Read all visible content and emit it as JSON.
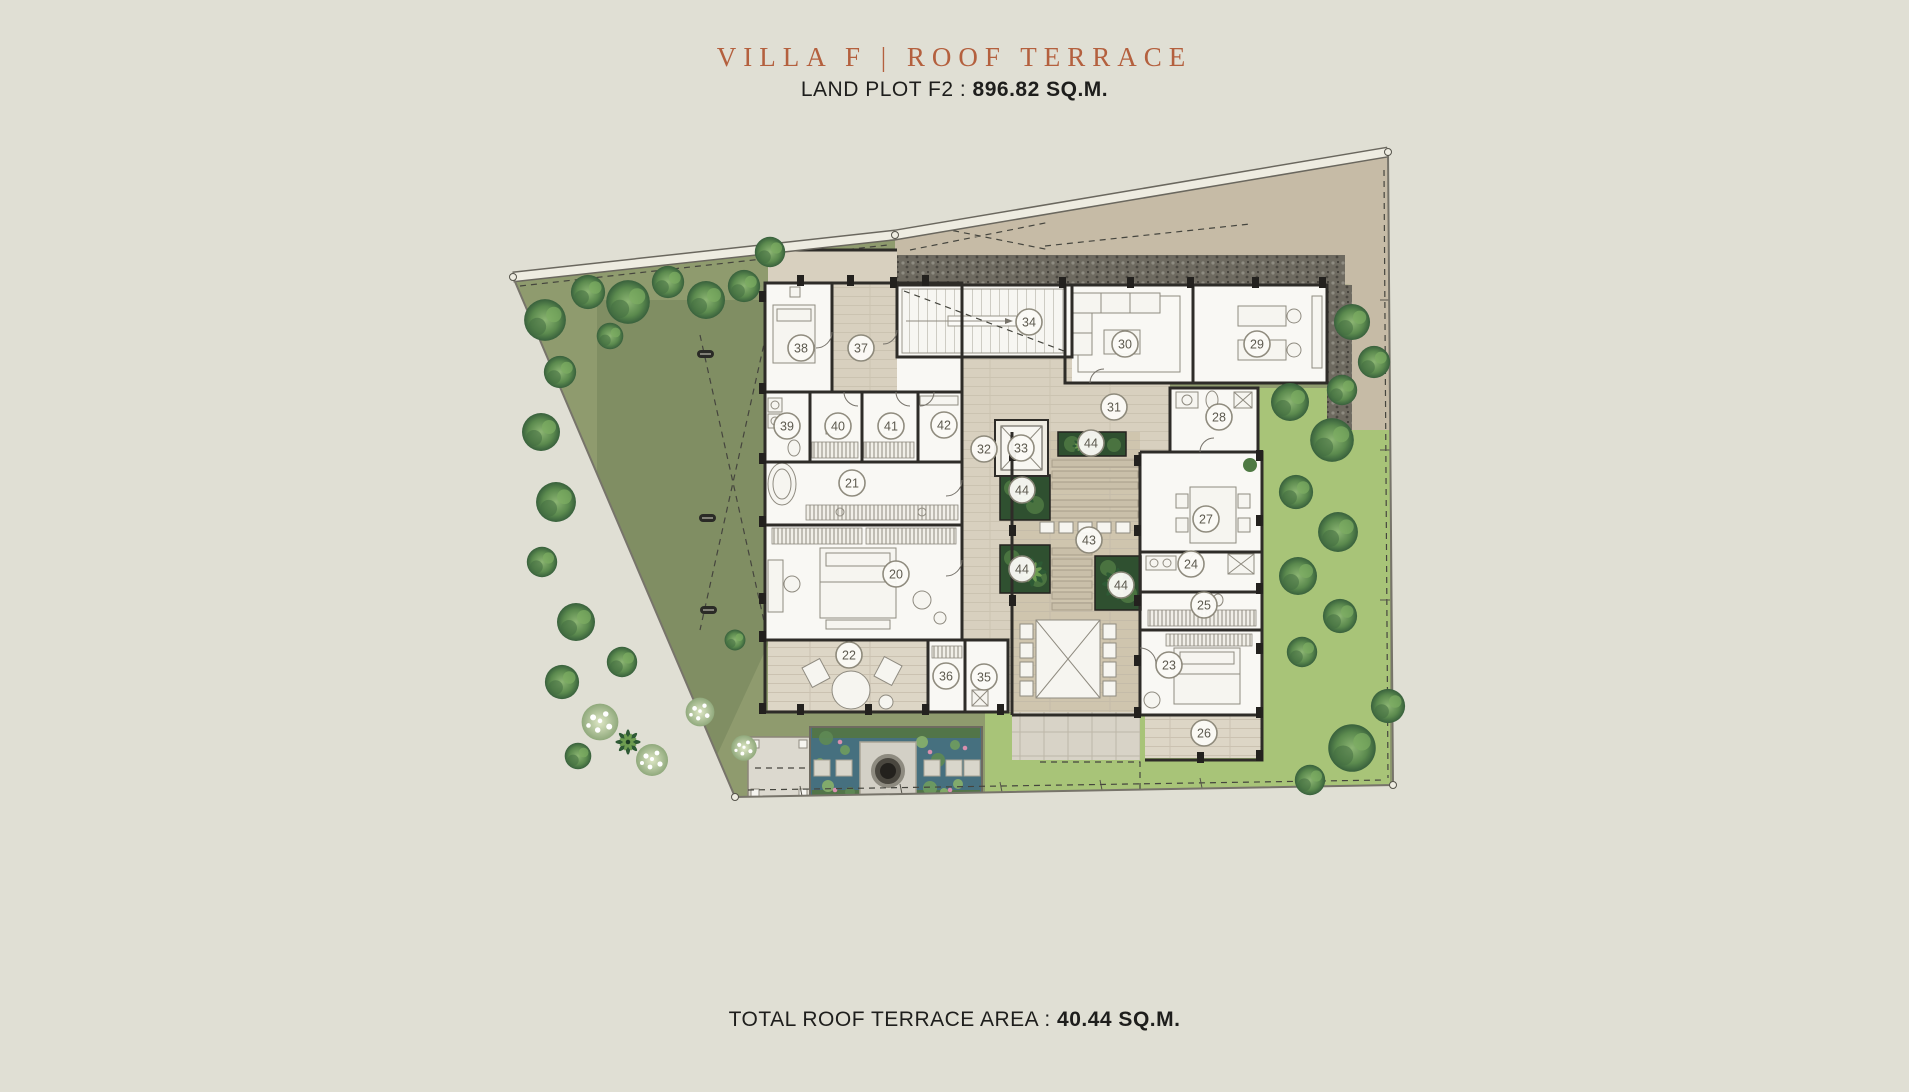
{
  "header": {
    "title": "VILLA F | ROOF TERRACE",
    "plot_label": "LAND PLOT F2 :",
    "plot_value": "896.82 SQ.M."
  },
  "footer": {
    "area_label": "TOTAL ROOF TERRACE AREA :",
    "area_value": "40.44 SQ.M."
  },
  "colors": {
    "background": "#e0dfd4",
    "title_accent": "#b4603e",
    "body_text": "#1e1e1c",
    "lawn": "#8f9b6e",
    "bright_lawn": "#a8c478",
    "pond": "#46707f",
    "wall": "#2e2c28"
  },
  "plan": {
    "description": "Villa F roof terrace level floor plan with numbered room markers",
    "markers": [
      {
        "label": "20",
        "x": 896,
        "y": 574
      },
      {
        "label": "21",
        "x": 852,
        "y": 483
      },
      {
        "label": "22",
        "x": 849,
        "y": 655
      },
      {
        "label": "23",
        "x": 1169,
        "y": 665
      },
      {
        "label": "24",
        "x": 1191,
        "y": 564
      },
      {
        "label": "25",
        "x": 1204,
        "y": 605
      },
      {
        "label": "26",
        "x": 1204,
        "y": 733
      },
      {
        "label": "27",
        "x": 1206,
        "y": 519
      },
      {
        "label": "28",
        "x": 1219,
        "y": 417
      },
      {
        "label": "29",
        "x": 1257,
        "y": 344
      },
      {
        "label": "30",
        "x": 1125,
        "y": 344
      },
      {
        "label": "31",
        "x": 1114,
        "y": 407
      },
      {
        "label": "32",
        "x": 984,
        "y": 449
      },
      {
        "label": "33",
        "x": 1021,
        "y": 448
      },
      {
        "label": "34",
        "x": 1029,
        "y": 322
      },
      {
        "label": "35",
        "x": 984,
        "y": 677
      },
      {
        "label": "36",
        "x": 946,
        "y": 676
      },
      {
        "label": "37",
        "x": 861,
        "y": 348
      },
      {
        "label": "38",
        "x": 801,
        "y": 348
      },
      {
        "label": "39",
        "x": 787,
        "y": 426
      },
      {
        "label": "40",
        "x": 838,
        "y": 426
      },
      {
        "label": "41",
        "x": 891,
        "y": 426
      },
      {
        "label": "42",
        "x": 944,
        "y": 425
      },
      {
        "label": "43",
        "x": 1089,
        "y": 540
      },
      {
        "label": "44",
        "x": 1091,
        "y": 443
      },
      {
        "label": "44",
        "x": 1022,
        "y": 490
      },
      {
        "label": "44",
        "x": 1022,
        "y": 569
      },
      {
        "label": "44",
        "x": 1121,
        "y": 585
      }
    ]
  }
}
